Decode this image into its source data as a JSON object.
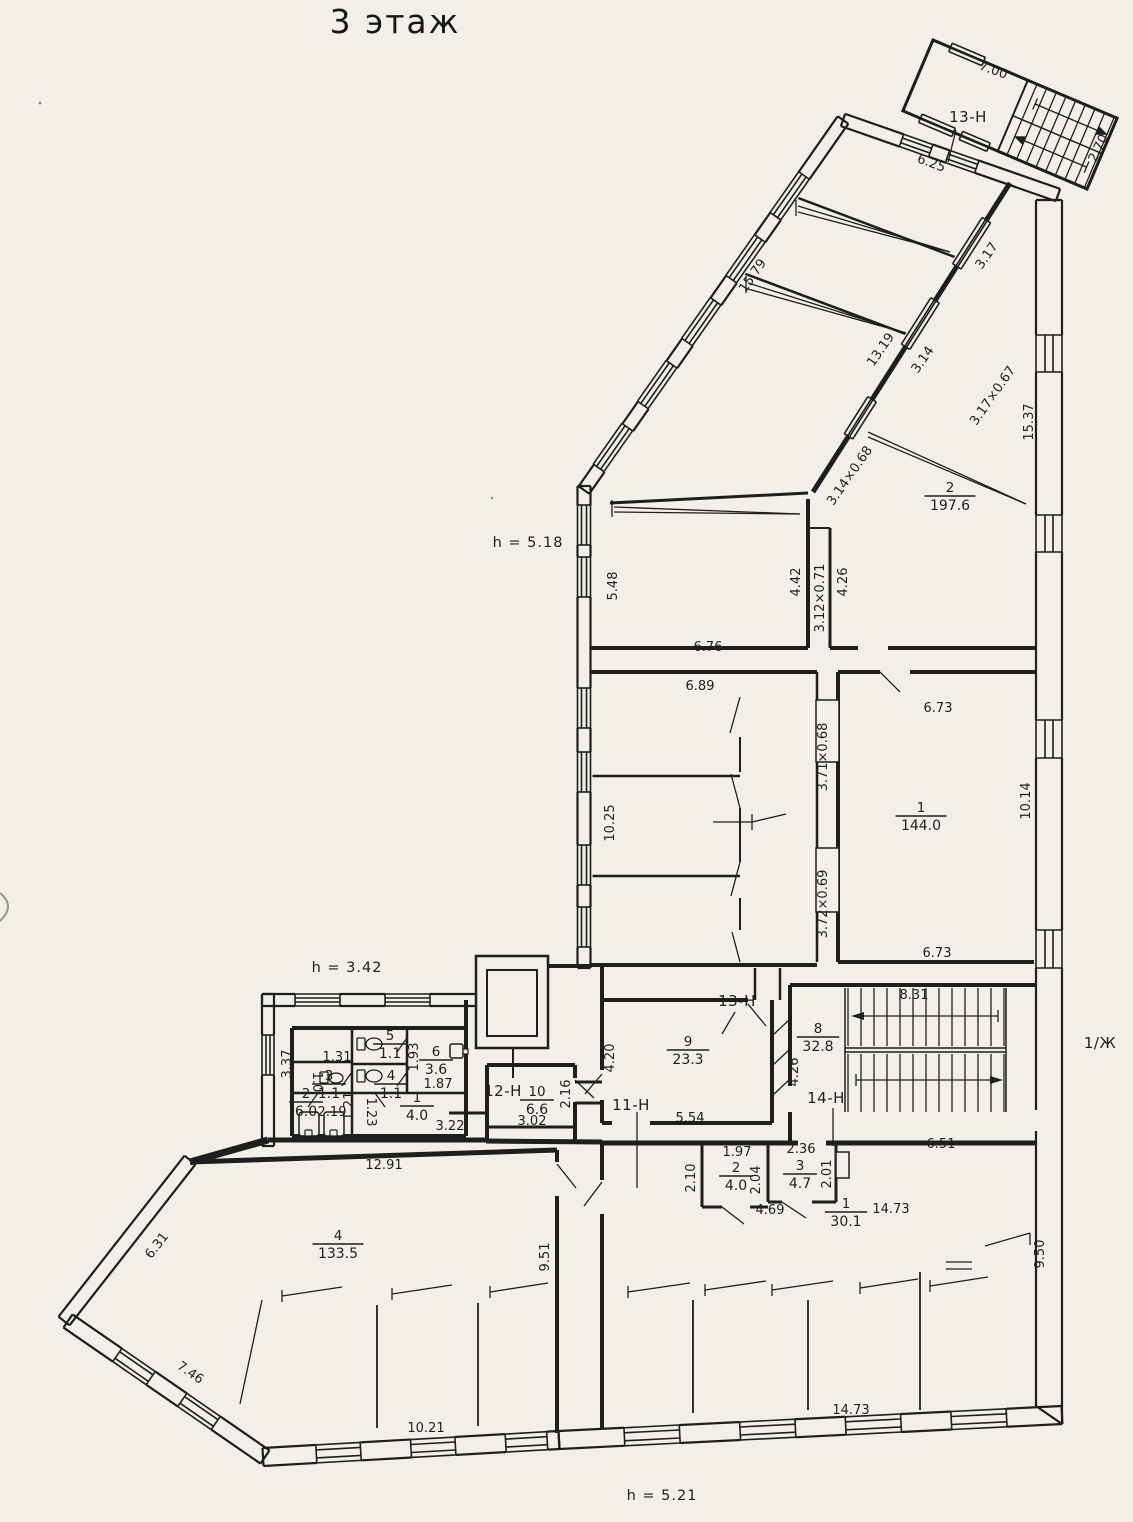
{
  "title": {
    "text": "3 этаж"
  },
  "colors": {
    "paper": "#f1efe8",
    "ink": "#1e1e1e"
  },
  "heights": [
    {
      "text": "h = 5.18",
      "x": 528,
      "y": 547
    },
    {
      "text": "h = 3.42",
      "x": 347,
      "y": 972
    },
    {
      "text": "h = 5.21",
      "x": 662,
      "y": 1500
    }
  ],
  "section_labels": [
    {
      "text": "13-Н",
      "x": 968,
      "y": 122
    },
    {
      "text": "13-Н",
      "x": 737,
      "y": 1006
    },
    {
      "text": "12-Н",
      "x": 503,
      "y": 1096
    },
    {
      "text": "11-Н",
      "x": 631,
      "y": 1110
    },
    {
      "text": "14-Н",
      "x": 826,
      "y": 1103
    },
    {
      "text": "1/Ж",
      "x": 1100,
      "y": 1048
    }
  ],
  "rooms": [
    {
      "number": "2",
      "area": "197.6",
      "x": 950,
      "y": 492
    },
    {
      "number": "1",
      "area": "144.0",
      "x": 921,
      "y": 812
    },
    {
      "number": "9",
      "area": "23.3",
      "x": 688,
      "y": 1046
    },
    {
      "number": "8",
      "area": "32.8",
      "x": 818,
      "y": 1033
    },
    {
      "number": "10",
      "area": "6.6",
      "x": 537,
      "y": 1096
    },
    {
      "number": "5",
      "area": "1.1",
      "x": 390,
      "y": 1040
    },
    {
      "number": "6",
      "area": "3.6",
      "x": 436,
      "y": 1056
    },
    {
      "number": "3",
      "area": "1.1",
      "x": 329,
      "y": 1080
    },
    {
      "number": "4",
      "area": "1.1",
      "x": 391,
      "y": 1080
    },
    {
      "number": "2",
      "area": "6.0",
      "x": 306,
      "y": 1098
    },
    {
      "number": "1",
      "area": "4.0",
      "x": 417,
      "y": 1102
    },
    {
      "number": "4",
      "area": "133.5",
      "x": 338,
      "y": 1240
    },
    {
      "number": "2",
      "area": "4.0",
      "x": 736,
      "y": 1172
    },
    {
      "number": "3",
      "area": "4.7",
      "x": 800,
      "y": 1170
    },
    {
      "number": "1",
      "area": "30.1",
      "x": 846,
      "y": 1208
    }
  ],
  "dimensions": [
    {
      "text": "7.00",
      "x": 992,
      "y": 74,
      "rot": 20
    },
    {
      "text": "6.25",
      "x": 930,
      "y": 167,
      "rot": 20
    },
    {
      "text": "2.70",
      "x": 1102,
      "y": 150,
      "rot": -64
    },
    {
      "text": "15.79",
      "x": 756,
      "y": 278,
      "rot": -55
    },
    {
      "text": "3.17",
      "x": 990,
      "y": 258,
      "rot": -55
    },
    {
      "text": "13.19",
      "x": 884,
      "y": 352,
      "rot": -55
    },
    {
      "text": "3.14",
      "x": 926,
      "y": 362,
      "rot": -55
    },
    {
      "text": "3.17×0.67",
      "x": 996,
      "y": 398,
      "rot": -55
    },
    {
      "text": "15.37",
      "x": 1033,
      "y": 422,
      "rot": -90
    },
    {
      "text": "3.14×0.68",
      "x": 853,
      "y": 478,
      "rot": -55
    },
    {
      "text": "5.48",
      "x": 617,
      "y": 586,
      "rot": -90
    },
    {
      "text": "4.42",
      "x": 800,
      "y": 582,
      "rot": -90
    },
    {
      "text": "3.12×0.71",
      "x": 824,
      "y": 598,
      "rot": -90
    },
    {
      "text": "4.26",
      "x": 847,
      "y": 582,
      "rot": -90
    },
    {
      "text": "6.76",
      "x": 708,
      "y": 651,
      "rot": 0
    },
    {
      "text": "6.73",
      "x": 938,
      "y": 712,
      "rot": 0
    },
    {
      "text": "6.89",
      "x": 700,
      "y": 690,
      "rot": 0
    },
    {
      "text": "10.25",
      "x": 614,
      "y": 823,
      "rot": -90
    },
    {
      "text": "3.71×0.68",
      "x": 827,
      "y": 757,
      "rot": -90
    },
    {
      "text": "10.14",
      "x": 1030,
      "y": 801,
      "rot": -90
    },
    {
      "text": "3.72×0.69",
      "x": 827,
      "y": 904,
      "rot": -90
    },
    {
      "text": "6.73",
      "x": 937,
      "y": 957,
      "rot": 0
    },
    {
      "text": "8.31",
      "x": 914,
      "y": 999,
      "rot": 0
    },
    {
      "text": "4.26",
      "x": 798,
      "y": 1072,
      "rot": -90
    },
    {
      "text": "4.20",
      "x": 614,
      "y": 1058,
      "rot": -90
    },
    {
      "text": "5.54",
      "x": 690,
      "y": 1122,
      "rot": 0
    },
    {
      "text": "2.16",
      "x": 570,
      "y": 1094,
      "rot": -90
    },
    {
      "text": "3.02",
      "x": 532,
      "y": 1125,
      "rot": 0
    },
    {
      "text": "3.37",
      "x": 291,
      "y": 1064,
      "rot": -90
    },
    {
      "text": "1.31",
      "x": 337,
      "y": 1061,
      "rot": 0
    },
    {
      "text": "1.93",
      "x": 418,
      "y": 1057,
      "rot": -90
    },
    {
      "text": "1.87",
      "x": 438,
      "y": 1088,
      "rot": 0
    },
    {
      "text": "1.0",
      "x": 313,
      "y": 1082,
      "rot": 90
    },
    {
      "text": "2.19",
      "x": 332,
      "y": 1116,
      "rot": 0
    },
    {
      "text": "1.21",
      "x": 353,
      "y": 1106,
      "rot": -90
    },
    {
      "text": "1.23",
      "x": 367,
      "y": 1112,
      "rot": 90
    },
    {
      "text": "3.22",
      "x": 450,
      "y": 1130,
      "rot": 0
    },
    {
      "text": "12.91",
      "x": 384,
      "y": 1169,
      "rot": 0
    },
    {
      "text": "6.31",
      "x": 160,
      "y": 1248,
      "rot": -52
    },
    {
      "text": "7.46",
      "x": 188,
      "y": 1376,
      "rot": 35
    },
    {
      "text": "10.21",
      "x": 426,
      "y": 1432,
      "rot": 0
    },
    {
      "text": "9.51",
      "x": 549,
      "y": 1257,
      "rot": -90
    },
    {
      "text": "1.97",
      "x": 737,
      "y": 1156,
      "rot": 0
    },
    {
      "text": "2.10",
      "x": 695,
      "y": 1178,
      "rot": -90
    },
    {
      "text": "2.04",
      "x": 760,
      "y": 1180,
      "rot": -90
    },
    {
      "text": "2.36",
      "x": 801,
      "y": 1153,
      "rot": 0
    },
    {
      "text": "2.01",
      "x": 831,
      "y": 1174,
      "rot": -90
    },
    {
      "text": "4.69",
      "x": 770,
      "y": 1214,
      "rot": 0
    },
    {
      "text": "6.51",
      "x": 941,
      "y": 1148,
      "rot": 0
    },
    {
      "text": "14.73",
      "x": 891,
      "y": 1213,
      "rot": 0
    },
    {
      "text": "9.50",
      "x": 1044,
      "y": 1254,
      "rot": -90
    },
    {
      "text": "14.73",
      "x": 851,
      "y": 1414,
      "rot": 0
    }
  ]
}
